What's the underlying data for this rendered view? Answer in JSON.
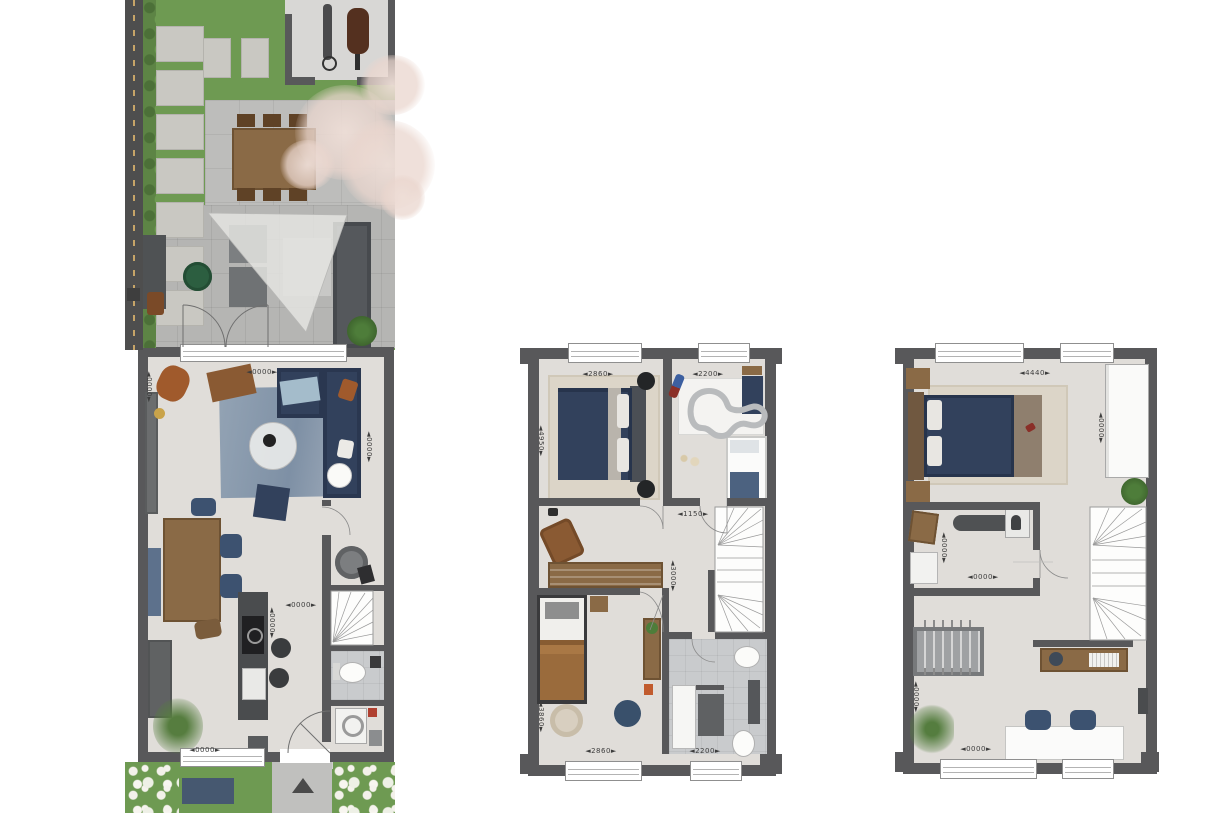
{
  "colors": {
    "wall": "#58585a",
    "floor": "#e0ddd9",
    "tile": "#c9cbcd",
    "grass": "#6e9a52",
    "paving": "#b5b5b3",
    "navy": "#32415c",
    "wood": "#8a6a46",
    "beige": "#dcd5c8"
  },
  "plans": {
    "ground": {
      "dims": {
        "living_width": "◄0000►",
        "living_depth_left": "◄0000►",
        "living_depth_right": "◄0000►",
        "hall_width": "◄0000►",
        "kitchen_depth": "◄0000►",
        "front_width": "◄0000►"
      }
    },
    "first": {
      "dims": {
        "bed1_width": "◄2860►",
        "bed2_width": "◄2200►",
        "bed1_depth": "◄4950►",
        "hall_width": "◄1150►",
        "hall_depth": "◄3000►",
        "bed3_depth": "◄3860►",
        "bed3_width": "◄2860►",
        "bath_width": "◄2200►"
      }
    },
    "second": {
      "dims": {
        "bed_width": "◄4440►",
        "bed_depth": "◄0000►",
        "laundry_depth": "◄0000►",
        "laundry_width": "◄0000►",
        "hobby_depth": "◄0000►",
        "hobby_width": "◄0000►"
      }
    }
  }
}
